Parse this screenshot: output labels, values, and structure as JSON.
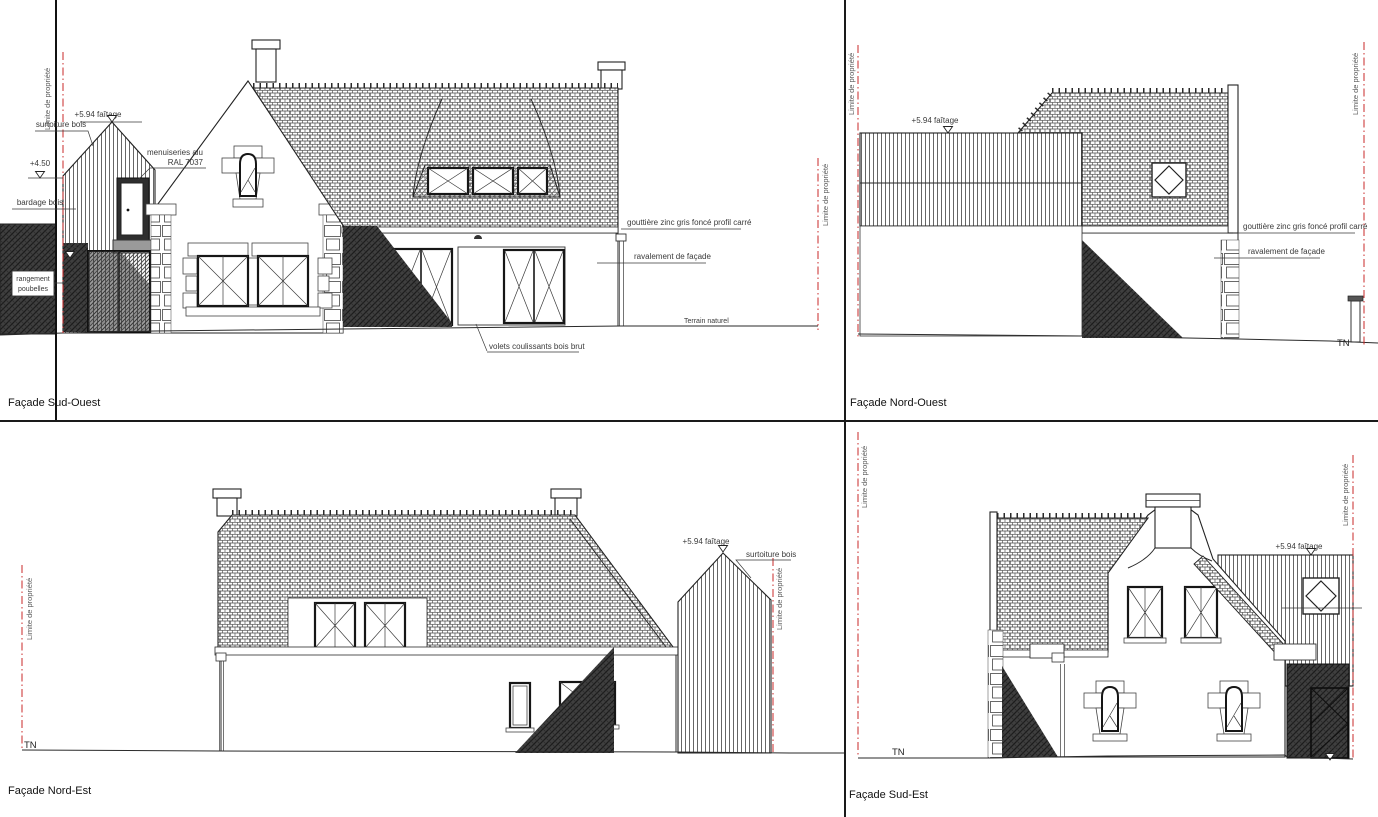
{
  "sheet": {
    "colors": {
      "line": "#1a1a1a",
      "property_line": "#c92a2a",
      "annotation_text": "#3a3a3a"
    }
  },
  "common": {
    "limite": "Limite de propriété",
    "faitage": "+5.94 faîtage",
    "gouttiere": "gouttière zinc gris foncé profil carré",
    "ravalement": "ravalement de façade",
    "surtoiture": "surtoiture bois",
    "tn": "TN"
  },
  "facade_sud_ouest": {
    "title": "Façade Sud-Ouest",
    "level_450": "+4.50",
    "level_215": "+2.15",
    "bardage": "bardage bois",
    "rangement_1": "rangement",
    "rangement_2": "poubelles",
    "menuiseries_1": "menuiseries alu",
    "menuiseries_2": "RAL 7037",
    "terrain_naturel": "Terrain naturel",
    "volets": "volets coulissants bois brut"
  },
  "facade_nord_ouest": {
    "title": "Façade Nord-Ouest"
  },
  "facade_nord_est": {
    "title": "Façade Nord-Est"
  },
  "facade_sud_est": {
    "title": "Façade Sud-Est",
    "level_000": "+0.00"
  }
}
